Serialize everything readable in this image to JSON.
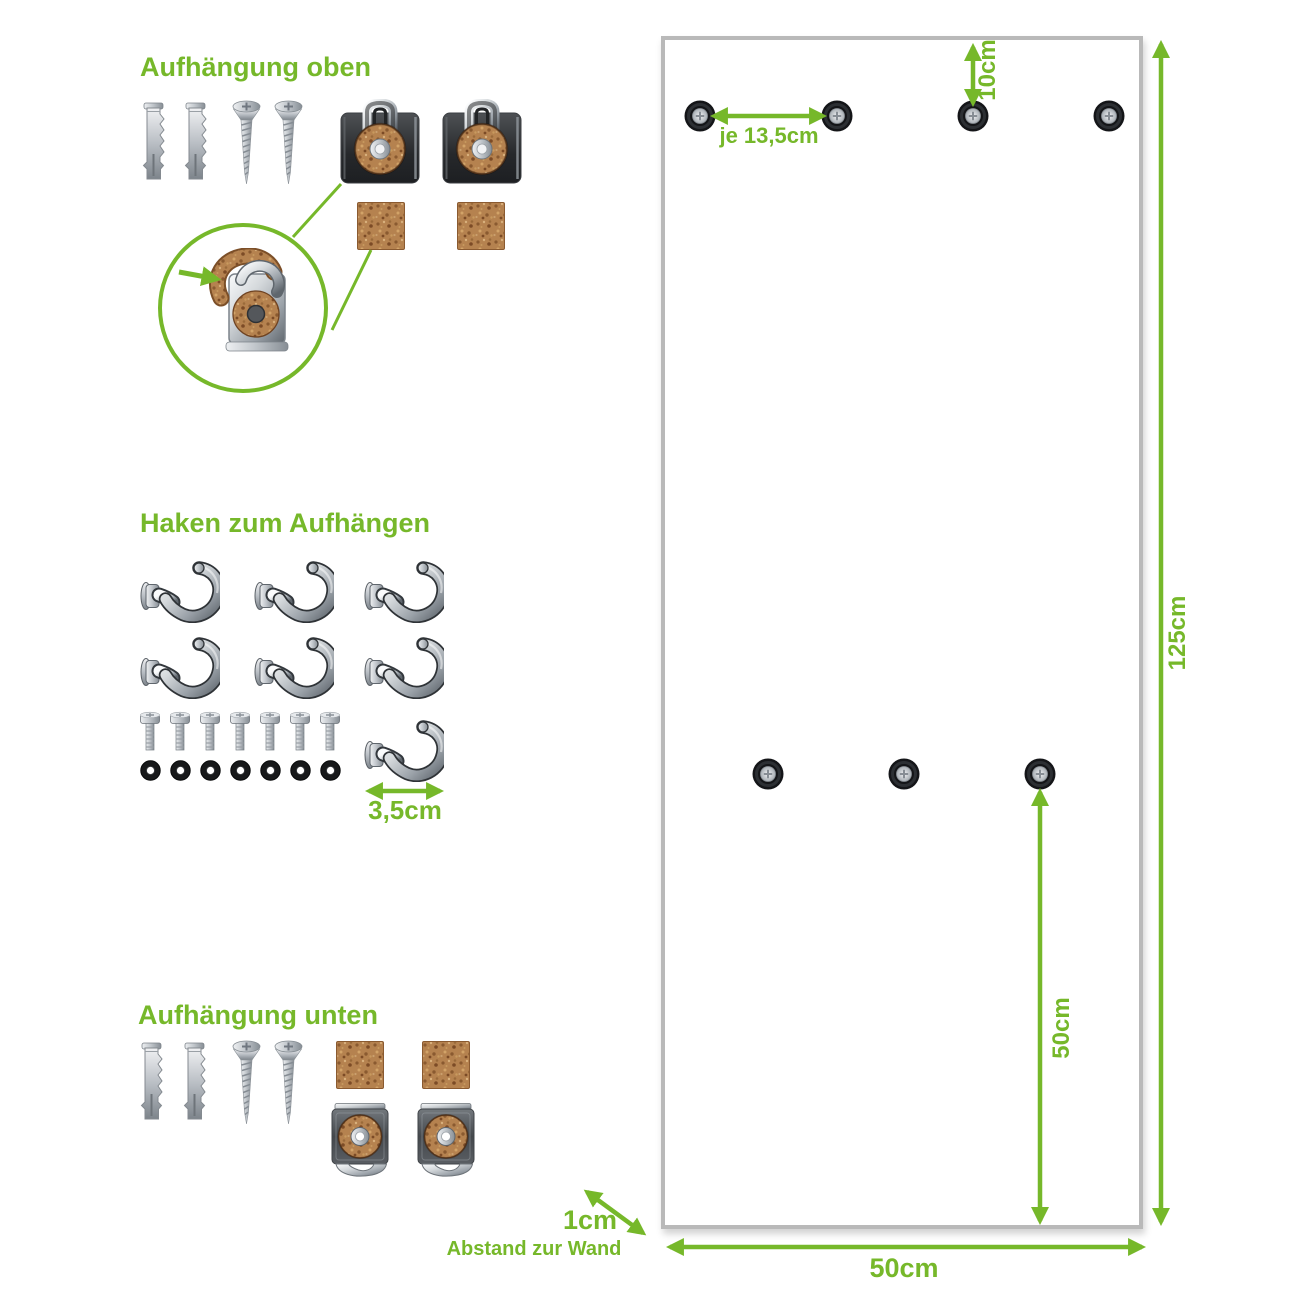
{
  "accent_color": "#76b82a",
  "panel_border_color": "#b9b9b9",
  "sections": {
    "top_mount": {
      "title": "Aufhängung oben",
      "parts": [
        {
          "icon": "wall-plug-icon",
          "count": 2
        },
        {
          "icon": "countersunk-screw-icon",
          "count": 2
        },
        {
          "icon": "glass-clip-top-icon",
          "count": 2
        },
        {
          "icon": "cork-pad-icon",
          "count": 2
        }
      ],
      "detail": {
        "icon": "clip-cork-detail-icon"
      }
    },
    "hooks": {
      "title": "Haken zum Aufhängen",
      "parts": [
        {
          "icon": "cup-hook-icon",
          "count": 7
        },
        {
          "icon": "hook-bolt-icon",
          "count": 7
        },
        {
          "icon": "hook-washer-icon",
          "count": 7
        }
      ],
      "hook_width_label": "3,5cm"
    },
    "bottom_mount": {
      "title": "Aufhängung unten",
      "parts": [
        {
          "icon": "wall-plug-icon",
          "count": 2
        },
        {
          "icon": "countersunk-screw-icon",
          "count": 2
        },
        {
          "icon": "cork-pad-icon",
          "count": 2
        },
        {
          "icon": "glass-clip-bottom-icon",
          "count": 2
        }
      ]
    }
  },
  "panel": {
    "hole_count_top": 4,
    "hole_count_middle": 3,
    "labels": {
      "hole_spacing": "je 13,5cm",
      "top_offset": "10cm",
      "height": "125cm",
      "bottom_hole_offset": "50cm",
      "width": "50cm",
      "wall_distance": "1cm",
      "wall_distance_caption": "Abstand zur Wand"
    }
  }
}
